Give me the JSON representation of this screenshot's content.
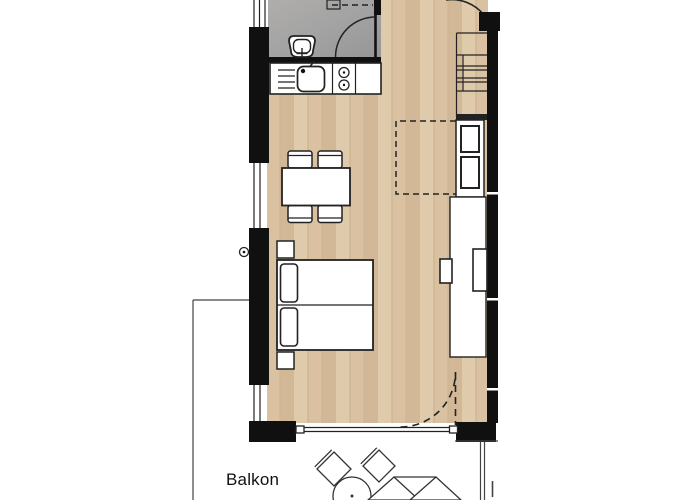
{
  "plan": {
    "balcony_label": "Balkon",
    "colors": {
      "background": "#ffffff",
      "wall": "#101010",
      "line": "#222222",
      "wood": "#d9c1a2",
      "wood_light": "#e0caac",
      "wood_dark": "#d2b897",
      "bathroom_floor": "#a3a3a3",
      "bathroom_floor_light": "#b0aeac"
    },
    "rooms": [
      {
        "name": "bathroom"
      },
      {
        "name": "kitchen-living-room"
      },
      {
        "name": "balcony"
      }
    ],
    "furniture_icons": [
      "toilet-icon",
      "kitchen-sink-icon",
      "stove-burners-icon",
      "dining-table",
      "dining-chairs",
      "double-bed",
      "pillows",
      "nightstands",
      "wardrobe",
      "tall-cabinet-appliances",
      "staircase",
      "balcony-chairs",
      "balcony-round-table",
      "sun-lounger",
      "door-swing-arcs",
      "windows"
    ]
  }
}
